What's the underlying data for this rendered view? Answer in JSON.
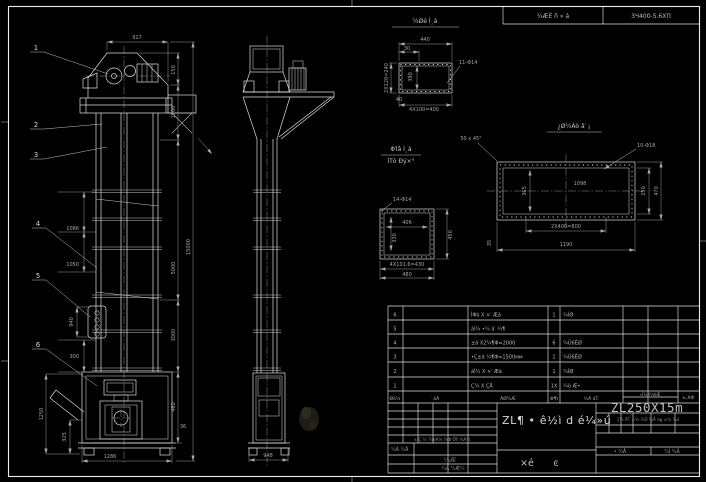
{
  "colors": {
    "background": "#000000",
    "linework": "#dcdcdc",
    "dim_text": "#a6a6a6",
    "bright_text": "#d8d8d8"
  },
  "header": {
    "cell1": "¼ÆÈ ñ » á",
    "cell2": "3Ч400-5.6ΧΠ"
  },
  "balloons": {
    "b1": "1",
    "b2": "2",
    "b3": "3",
    "b4": "4",
    "b5": "5",
    "b6": "6"
  },
  "front": {
    "d917": "917",
    "d150": "150",
    "d1500": "1500",
    "d5000": "5000",
    "d3000": "3000",
    "d460": "460",
    "d36": "36",
    "d15000": "15000",
    "d1086": "1086",
    "d1050": "1050",
    "d940": "940",
    "d300": "300",
    "d1250": "1250",
    "d325": "325",
    "d1286": "1286"
  },
  "side": {
    "d948": "948"
  },
  "detail_a": {
    "title": "½Øé Ì¸á",
    "d440": "440",
    "d30": "30",
    "d2x120": "2X120=240",
    "d390": "390",
    "d40": "40",
    "d4x100": "4X100=400",
    "holes": "11-Φ14"
  },
  "detail_b": {
    "title1": "ΦΊâ Ì¸á",
    "title2": "ÌΤò Ðý×°",
    "holes": "14-Φ14",
    "d406": "406",
    "d330": "330",
    "d450": "450",
    "d4x101": "4X101.6=430",
    "d480": "480"
  },
  "detail_c": {
    "title": "¿Ø½Àò â′ ¡",
    "chamfer": "50 x 45°",
    "holes": "10-Φ18",
    "d1098": "1098",
    "d365": "365",
    "d250": "250",
    "d470": "470",
    "d2x400": "2X400=800",
    "d1190": "1190",
    "d35": "35"
  },
  "table": {
    "headers": {
      "no": "Øò¼",
      "code": "′ áÃ",
      "name": "ÃØ¼Æ",
      "qty": "Φ¶ì",
      "material": "¾Ã áΤ",
      "weight": "»Ì¼X¼ÞÆ",
      "remark": "±,XΦ"
    },
    "rows": [
      {
        "no": "6",
        "name": "ÌΦò X ×′ Æá",
        "qty": "1",
        "material": "¼ÌØ"
      },
      {
        "no": "5",
        "name": "áÌ¼ •¼ á′ ¼¶",
        "qty": "",
        "material": ""
      },
      {
        "no": "4",
        "name": "±á X2¼¶Φ=2000",
        "qty": "6",
        "material": "¼Ü6ÊØ"
      },
      {
        "no": "3",
        "name": "•Ç±á ¼¶Φ=1500мм",
        "qty": "1",
        "material": "¼Ü6ÊØ"
      },
      {
        "no": "2",
        "name": "áÌ¼ X ×′ Æá",
        "qty": "1",
        "material": "¼ÌØ"
      },
      {
        "no": "1",
        "name": "Ç¼ X ÇÅ",
        "qty": "1X",
        "material": "¼ô Æ•"
      }
    ]
  },
  "tblock": {
    "title": "ZL¶ • ê½ì d é¼»ú",
    "model": "ZL250X15m",
    "sub1": "×é",
    "sub2": "ͼ",
    "rev_row": "±ÏÇ ¼′ ¼ÞÁ¼ ¼Φ ÕÝ ¼Ã¼",
    "design": "¼Ã ¼Å",
    "stamp1": "¼Æ",
    "stamp2": "¼Ã ¼Æ¼",
    "mini": "1¼ ÃΤ ±¼ ¼Ü ¼Å ag ±¼ ¼ü",
    "sheet1": "• ¼Å",
    "sheet2": "¼Ì ¼Å"
  }
}
